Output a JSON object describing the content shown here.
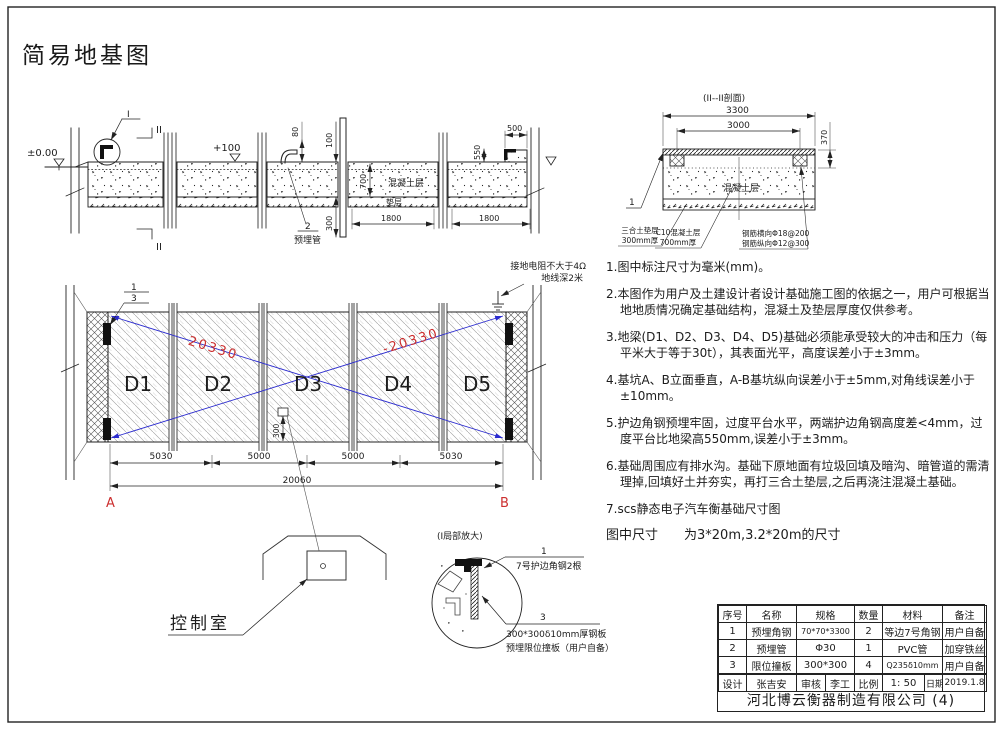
{
  "title": "简易地基图",
  "colors": {
    "red": "#cc2f2f",
    "blue": "#2b2bcf",
    "line": "#1c1c1c"
  },
  "top_section": {
    "level_zero": "±0.00",
    "level_plus100": "+100",
    "detail_callout": "I",
    "section_mark_top": "II",
    "section_mark_bottom": "II",
    "dim_80": "80",
    "dim_100": "100",
    "dim_700": "700",
    "dim_300": "300",
    "dim_550": "550",
    "dim_500": "500",
    "dim_1800_left": "1800",
    "dim_1800_right": "1800",
    "label_concrete": "混凝土层",
    "label_cushion": "垫层",
    "pipe_callout_no": "2",
    "pipe_callout_label": "预埋管"
  },
  "section_ii": {
    "title": "(II--II剖面)",
    "dim_3300": "3300",
    "dim_3000": "3000",
    "dim_370": "370",
    "label_concrete": "混凝土层",
    "callout_no": "1",
    "label_cushion_1": "三合土垫层",
    "label_cushion_2": "300mm厚",
    "label_c10_1": "C10混凝土层",
    "label_c10_2": "700mm厚",
    "label_rebar_1": "钢筋横向Φ18@200",
    "label_rebar_2": "钢筋纵向Φ12@300"
  },
  "plan": {
    "blocks": [
      "D1",
      "D2",
      "D3",
      "D4",
      "D5"
    ],
    "diag_left": "20330",
    "diag_right": "-20330",
    "ground_note_1": "接地电阻不大于4Ω",
    "ground_note_2": "地线深2米",
    "callout_top_1": "1",
    "callout_top_3": "3",
    "dim_300": "300",
    "dim_5030_l": "5030",
    "dim_5000_l": "5000",
    "dim_5000_r": "5000",
    "dim_5030_r": "5030",
    "dim_total": "20060",
    "mark_a": "A",
    "mark_b": "B"
  },
  "control_room": {
    "label": "控制室"
  },
  "detail": {
    "title": "(I局部放大)",
    "callout1_no": "1",
    "callout1_text": "7号护边角钢2根",
    "callout3_no": "3",
    "callout3_line1": "300*300δ10mm厚钢板",
    "callout3_line2": "预埋限位撞板（用户自备）"
  },
  "notes": [
    "1.图中标注尺寸为毫米(mm)。",
    "2.本图作为用户及土建设计者设计基础施工图的依据之一，用户可根据当地地质情况确定基础结构，混凝土及垫层厚度仅供参考。",
    "3.地梁(D1、D2、D3、D4、D5)基础必须能承受较大的冲击和压力（每平米大于等于30t），其表面光平，高度误差小于±3mm。",
    "4.基坑A、B立面垂直，A-B基坑纵向误差小于±5mm,对角线误差小于±10mm。",
    "5.护边角钢预埋牢固，过度平台水平，两端护边角钢高度差<4mm，过度平台比地梁高550mm,误差小于±3mm。",
    "6.基础周围应有排水沟。基础下原地面有垃圾回填及暗沟、暗管道的需清理掉,回填好土并夯实，再打三合土垫层,之后再浇注混凝土基础。",
    "7.scs静态电子汽车衡基础尺寸图"
  ],
  "notes_size_line": "图中尺寸　　为3*20m,3.2*20m的尺寸",
  "table": {
    "headers": [
      "序号",
      "名称",
      "规格",
      "数量",
      "材料",
      "备注"
    ],
    "rows": [
      [
        "1",
        "预埋角钢",
        "70*70*3300",
        "2",
        "等边7号角钢",
        "用户自备"
      ],
      [
        "2",
        "预埋管",
        "Φ30",
        "1",
        "PVC管",
        "加穿铁丝"
      ],
      [
        "3",
        "限位撞板",
        "300*300",
        "4",
        "Q235δ10mm",
        "用户自备"
      ]
    ],
    "sign": {
      "design_label": "设计",
      "design": "张吉安",
      "check_label": "审核",
      "check": "李工",
      "scale_label": "比例",
      "scale": "1: 50",
      "date_label": "日期",
      "date": "2019.1.8"
    },
    "company": "河北博云衡器制造有限公司 (4)"
  }
}
